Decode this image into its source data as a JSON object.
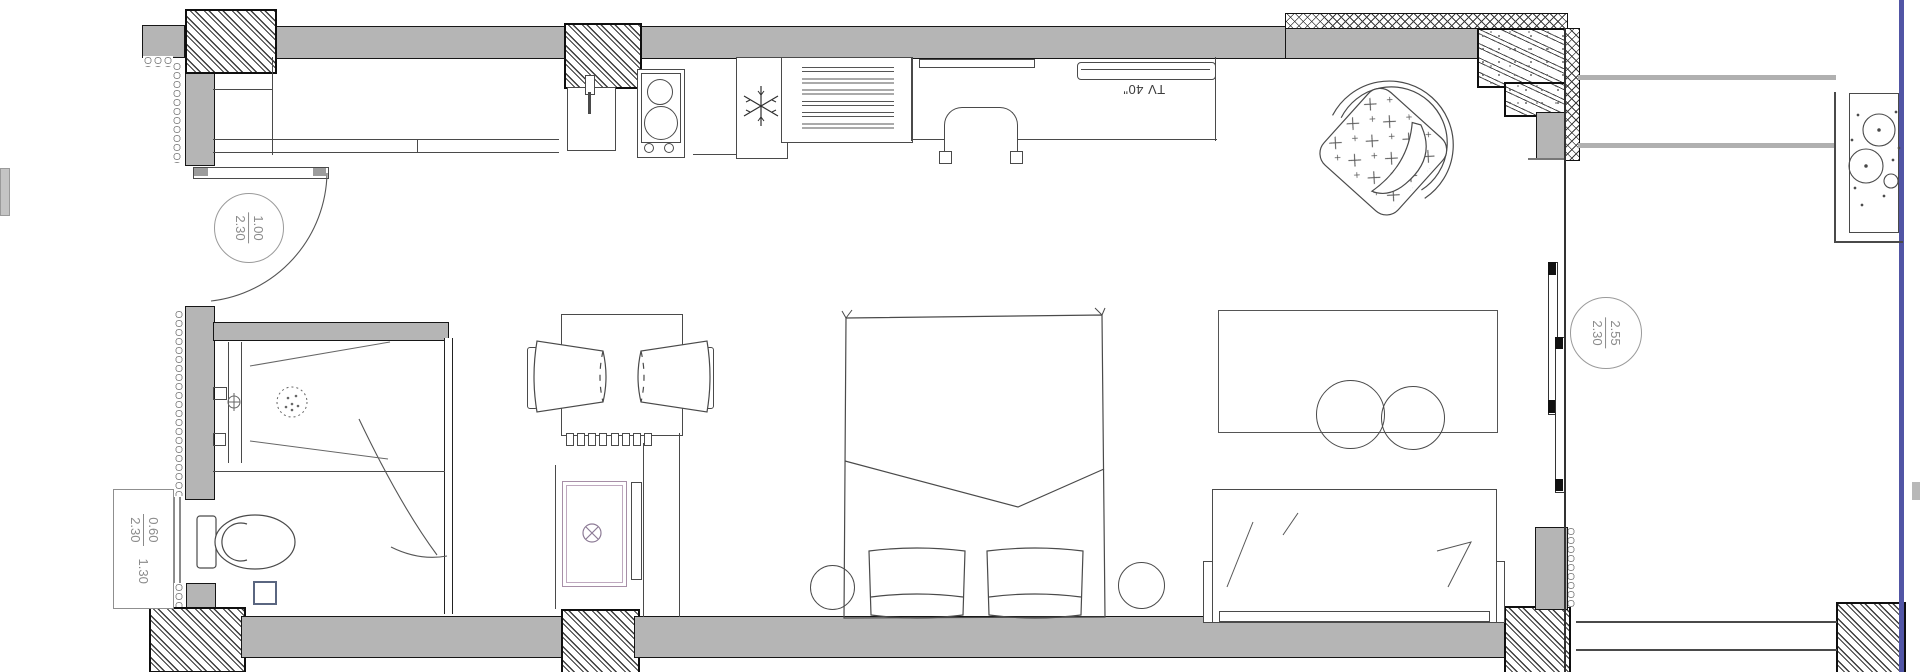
{
  "labels": {
    "tv": "TV 40\""
  },
  "tags": {
    "entry_door": {
      "numerator": "1.00",
      "denominator": "2.30"
    },
    "bath_window": {
      "numerator": "0.60",
      "denominator": "2.30",
      "extra": "1.30"
    },
    "balcony_door": {
      "numerator": "2.55",
      "denominator": "2.30"
    }
  },
  "colors": {
    "wall_fill": "#b5b5b5",
    "outline": "#161616",
    "thin_line": "#4a4a4a",
    "tag_text": "#8a8a8a",
    "mirror_accent": "#a78fa7",
    "drain_accent": "#5a6680",
    "page_edge": "#5155a5"
  },
  "icons": {
    "fridge": "snowflake-icon",
    "ceiling_light": "crossed-circle-icon"
  }
}
